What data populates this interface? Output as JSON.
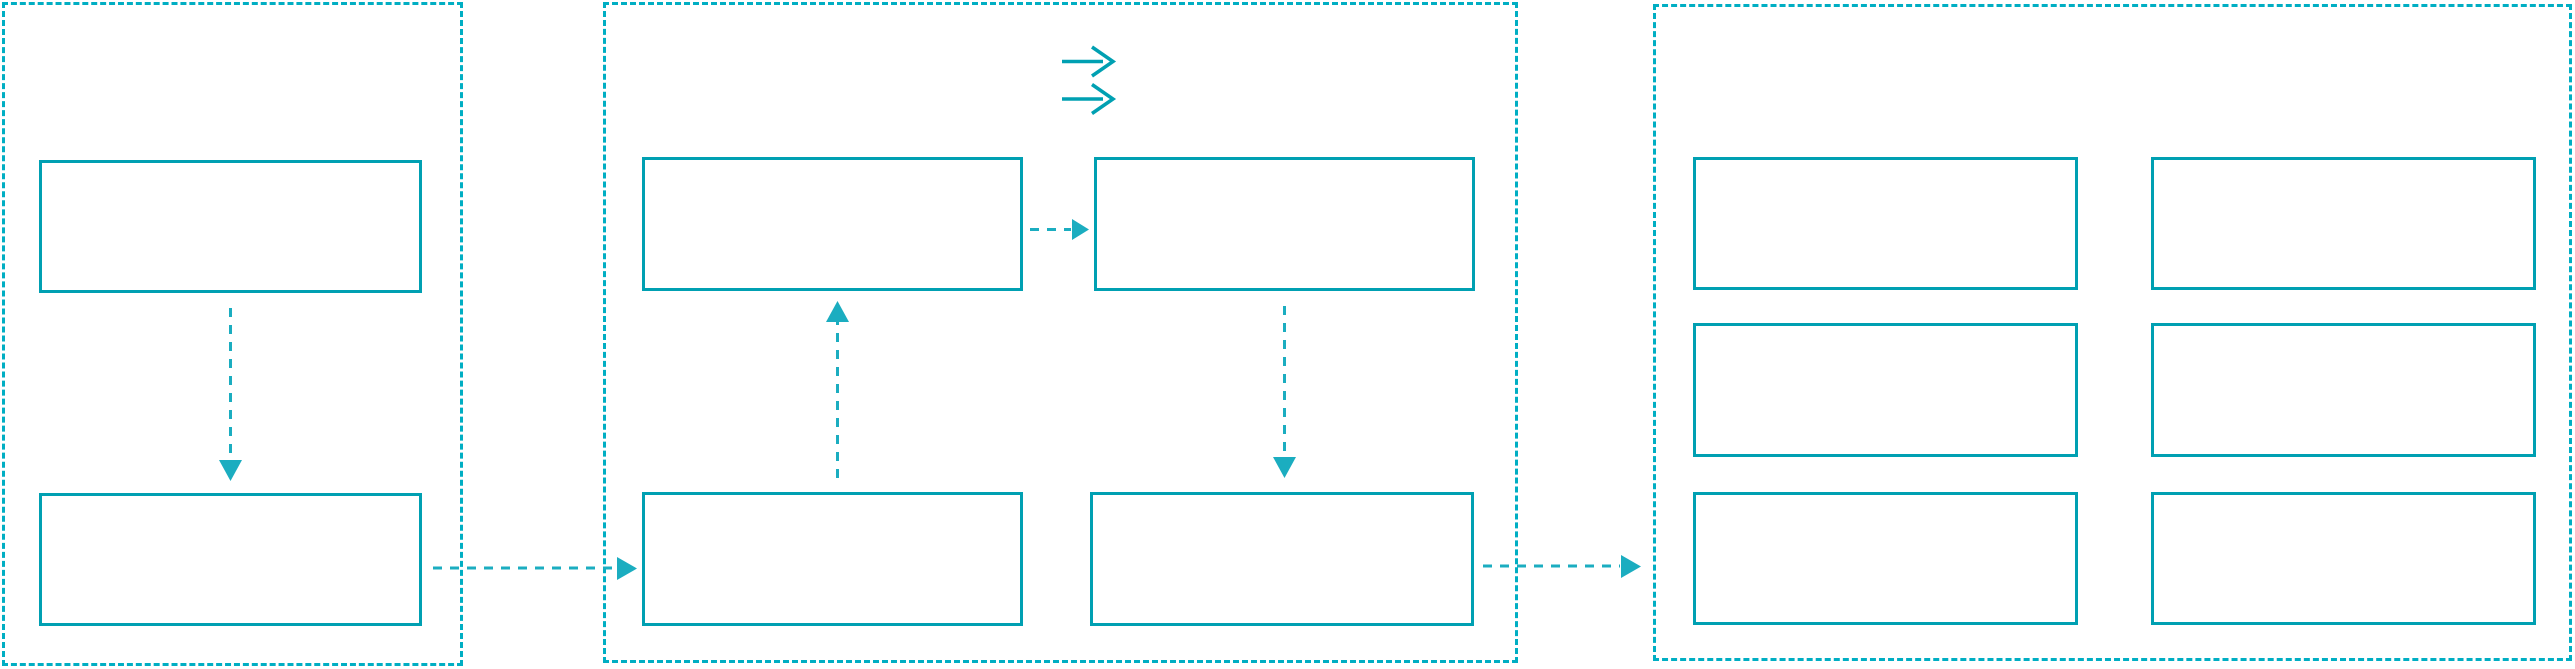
{
  "meta": {
    "title": "Three-panel flow wireframe diagram",
    "has_text": false
  },
  "theme": {
    "canvas_bg": "#ffffff",
    "panel_border": "#00aec3",
    "box_border": "#00a0b2",
    "connector": "#1badc0"
  },
  "icons": {
    "double_right_arrow": {
      "name": "double-right-arrow-icon",
      "glyph": "⇉",
      "location": "top-center of middle panel"
    }
  },
  "diagram": {
    "type": "flow",
    "panels": [
      {
        "id": "panel-left",
        "label": "",
        "border_style": "dashed",
        "boxes": [
          {
            "id": "left-box-top",
            "label": ""
          },
          {
            "id": "left-box-bottom",
            "label": ""
          }
        ]
      },
      {
        "id": "panel-middle",
        "label": "",
        "border_style": "dashed",
        "boxes": [
          {
            "id": "middle-box-top-left",
            "label": ""
          },
          {
            "id": "middle-box-top-right",
            "label": ""
          },
          {
            "id": "middle-box-bottom-left",
            "label": ""
          },
          {
            "id": "middle-box-bottom-right",
            "label": ""
          }
        ]
      },
      {
        "id": "panel-right",
        "label": "",
        "border_style": "dashed",
        "boxes": [
          {
            "id": "right-box-row1-col1",
            "label": ""
          },
          {
            "id": "right-box-row1-col2",
            "label": ""
          },
          {
            "id": "right-box-row2-col1",
            "label": ""
          },
          {
            "id": "right-box-row2-col2",
            "label": ""
          },
          {
            "id": "right-box-row3-col1",
            "label": ""
          },
          {
            "id": "right-box-row3-col2",
            "label": ""
          }
        ]
      }
    ],
    "connectors": [
      {
        "from": "left-box-top",
        "to": "left-box-bottom",
        "style": "dashed-arrow",
        "direction": "down"
      },
      {
        "from": "left-box-bottom",
        "to": "middle-box-bottom-left",
        "style": "dashed-arrow",
        "direction": "right"
      },
      {
        "from": "middle-box-top-left",
        "to": "middle-box-top-right",
        "style": "dashed-arrow",
        "direction": "right"
      },
      {
        "from": "middle-box-bottom-left",
        "to": "middle-box-top-left",
        "style": "dashed-arrow",
        "direction": "up"
      },
      {
        "from": "middle-box-top-right",
        "to": "middle-box-bottom-right",
        "style": "dashed-arrow",
        "direction": "down"
      },
      {
        "from": "middle-box-bottom-right",
        "to": "panel-right",
        "style": "dashed-arrow",
        "direction": "right"
      }
    ]
  }
}
